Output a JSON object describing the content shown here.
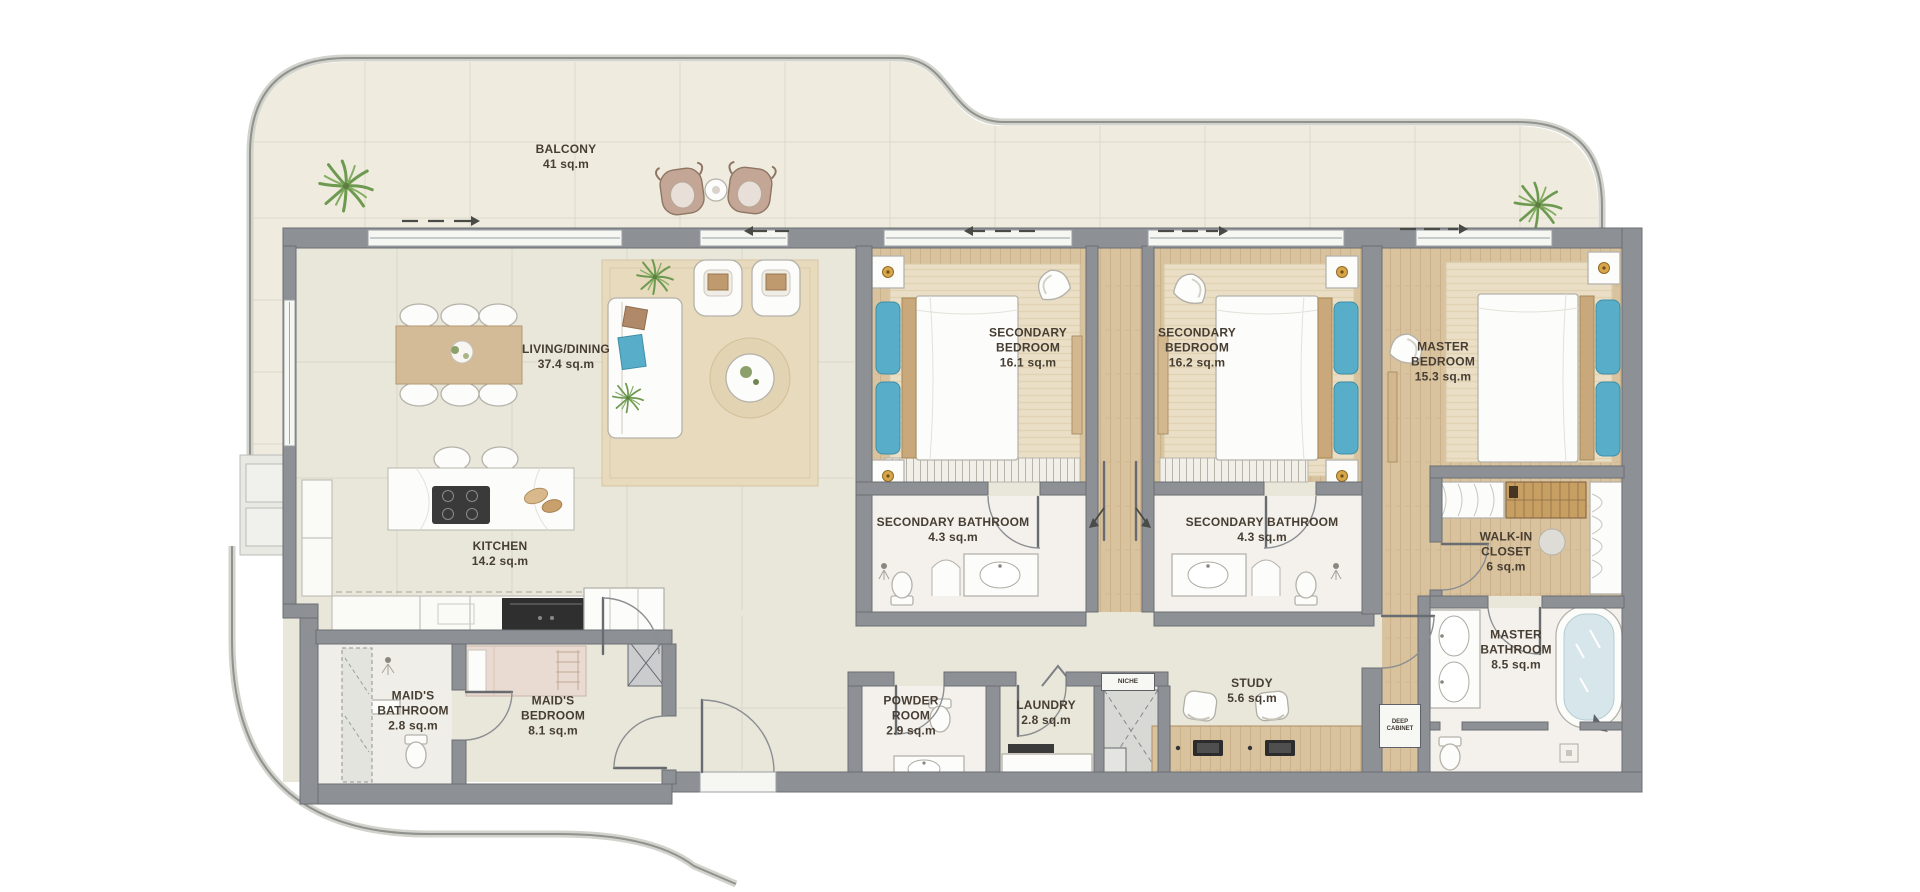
{
  "page": {
    "type": "apartment-floor-plan"
  },
  "colors": {
    "wall": "#8d9196",
    "floor_tile": "#e9e6da",
    "balcony_floor": "#efecdf",
    "wood": "#d9c29e",
    "rug": "#e8dbc0",
    "marble": "#f4f1ec",
    "accent_blue": "#58aec8",
    "label_text": "#473e33",
    "plant_green": "#6d9a50"
  },
  "rooms": [
    {
      "id": "balcony",
      "name": "BALCONY",
      "area": "41 sq.m"
    },
    {
      "id": "living_dining",
      "name": "LIVING/DINING",
      "area": "37.4 sq.m"
    },
    {
      "id": "kitchen",
      "name": "KITCHEN",
      "area": "14.2 sq.m"
    },
    {
      "id": "secondary_bedroom_1",
      "name": "SECONDARY BEDROOM",
      "area": "16.1 sq.m"
    },
    {
      "id": "secondary_bedroom_2",
      "name": "SECONDARY BEDROOM",
      "area": "16.2 sq.m"
    },
    {
      "id": "master_bedroom",
      "name": "MASTER BEDROOM",
      "area": "15.3 sq.m"
    },
    {
      "id": "secondary_bathroom_1",
      "name": "SECONDARY BATHROOM",
      "area": "4.3 sq.m"
    },
    {
      "id": "secondary_bathroom_2",
      "name": "SECONDARY BATHROOM",
      "area": "4.3 sq.m"
    },
    {
      "id": "walk_in_closet",
      "name": "WALK-IN CLOSET",
      "area": "6 sq.m"
    },
    {
      "id": "master_bathroom",
      "name": "MASTER BATHROOM",
      "area": "8.5 sq.m"
    },
    {
      "id": "maids_bathroom",
      "name": "MAID'S BATHROOM",
      "area": "2.8 sq.m"
    },
    {
      "id": "maids_bedroom",
      "name": "MAID'S BEDROOM",
      "area": "8.1 sq.m"
    },
    {
      "id": "powder_room",
      "name": "POWDER ROOM",
      "area": "2.9 sq.m"
    },
    {
      "id": "laundry",
      "name": "LAUNDRY",
      "area": "2.8 sq.m"
    },
    {
      "id": "study",
      "name": "STUDY",
      "area": "5.6 sq.m"
    }
  ],
  "fixtures": {
    "niche": "NICHE",
    "deep_cabinet": "DEEP CABINET"
  }
}
